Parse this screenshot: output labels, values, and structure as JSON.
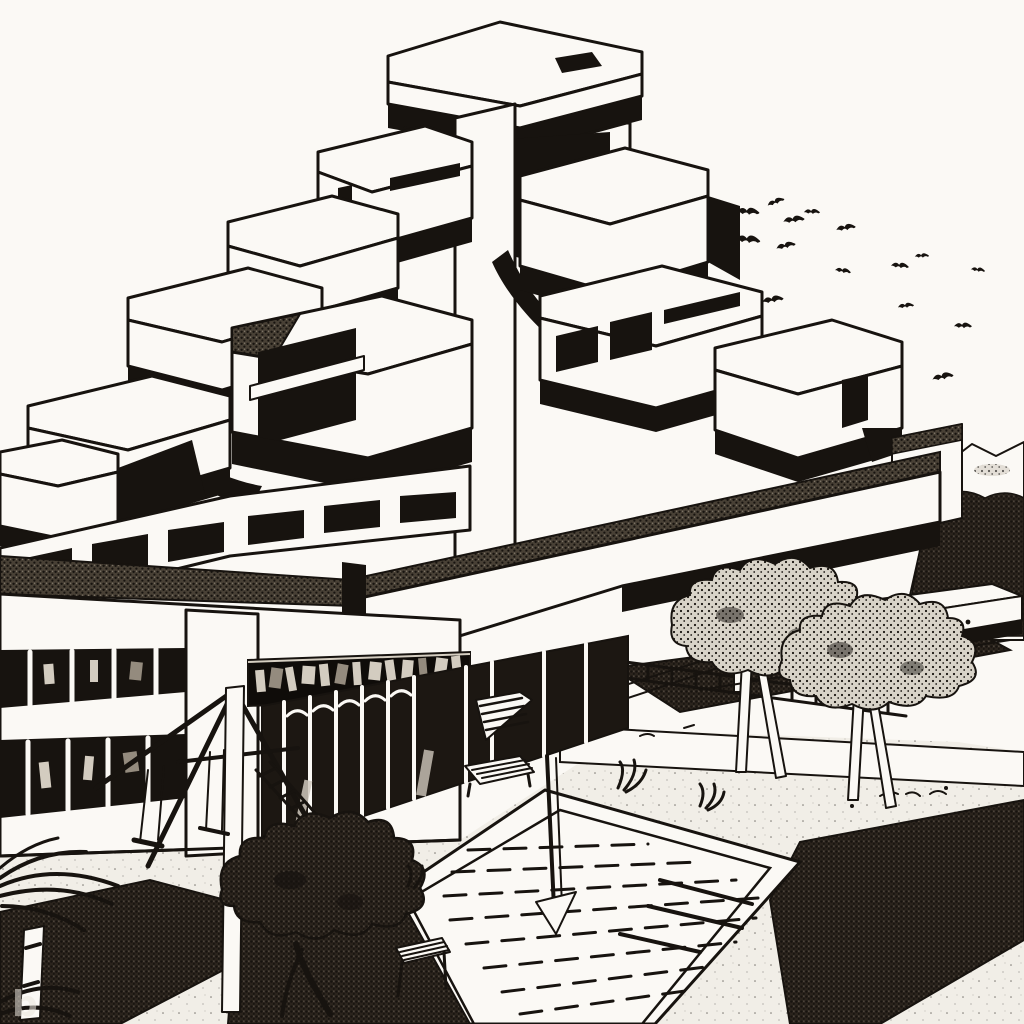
{
  "watermark": {
    "label": "b"
  },
  "palette": {
    "ink": "#17130f",
    "paper": "#fbf9f5",
    "plaza": "#f1eee7"
  },
  "scene": {
    "style": "black-and-white pen-and-ink architectural illustration",
    "subject": "stepped brutalist modular housing complex over a plaza with a sunken swimming pool",
    "sky": "blank white",
    "bird_count": 19,
    "tree_count": 3,
    "storefront_sign_text_legible": false,
    "elements": [
      "stacked concrete module towers with black shadow bands",
      "long white walkway slab",
      "lower commercial wing with ribbon windows and illegible dark sign band",
      "dark glazed arcade with mullions",
      "sunken square pool with hand-drawn lane strokes and ladder",
      "stippled planters and hedges",
      "two light stippled trees with forked trunks",
      "one dark stippled tree",
      "playground A-frame with swings and ladder",
      "palm fronds at lower-left edge",
      "hills and dark foliage at right horizon",
      "flock of birds upper right",
      "benches and lounge chair",
      "faint letter-b watermark lower-left"
    ]
  }
}
